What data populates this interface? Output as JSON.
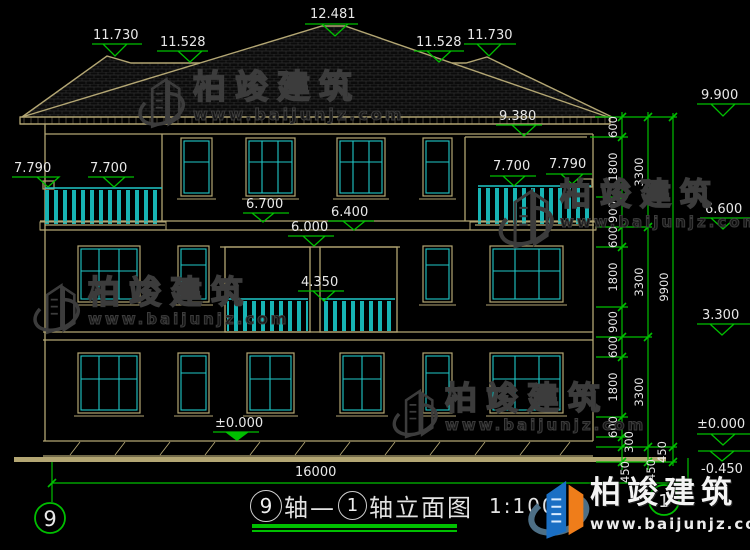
{
  "colors": {
    "background": "#000000",
    "line_tan": "#b3a673",
    "window_cyan": "#1fc7c7",
    "dim_green": "#00bf00",
    "text_white": "#e8e8e8",
    "watermark_gray": "#3c3c3c",
    "logo_blue": "#1a6fc4",
    "logo_orange": "#ef7d1a"
  },
  "roof_markers": {
    "left_11730": "11.730",
    "left_11528": "11.528",
    "peak_12481": "12.481",
    "right_11528": "11.528",
    "right_11730": "11.730",
    "eave_9380": "9.380"
  },
  "balcony_markers": {
    "left_7790": "7.790",
    "left_7700": "7.700",
    "right_7700": "7.700",
    "right_7790": "7.790",
    "mid_4350": "4.350"
  },
  "floor_markers": {
    "m6700": "6.700",
    "m6400": "6.400",
    "m6000": "6.000",
    "zero_mid": "±0.000"
  },
  "right_levels": {
    "l9900": "9.900",
    "l6600": "6.600",
    "l3300": "3.300",
    "l0000": "±0.000",
    "lm0450": "-0.450"
  },
  "dim_chains": {
    "inner": [
      "600",
      "1800",
      "900",
      "600",
      "1800",
      "900",
      "600",
      "1800",
      "600",
      "300"
    ],
    "inner_bottom": "450",
    "mid": [
      "3300",
      "3300",
      "3300"
    ],
    "mid_bottom": "450",
    "outer": "9900",
    "outer_bottom": "450",
    "total_width": "16000"
  },
  "axes": {
    "left_bubble": "9",
    "right_bubble": "1"
  },
  "title": {
    "bubble_start": "9",
    "text_mid": "轴—",
    "bubble_end": "1",
    "text_end": "轴立面图",
    "scale": "1:100"
  },
  "brand": {
    "name": "柏竣建筑",
    "url": "www.baijunjz.com"
  }
}
